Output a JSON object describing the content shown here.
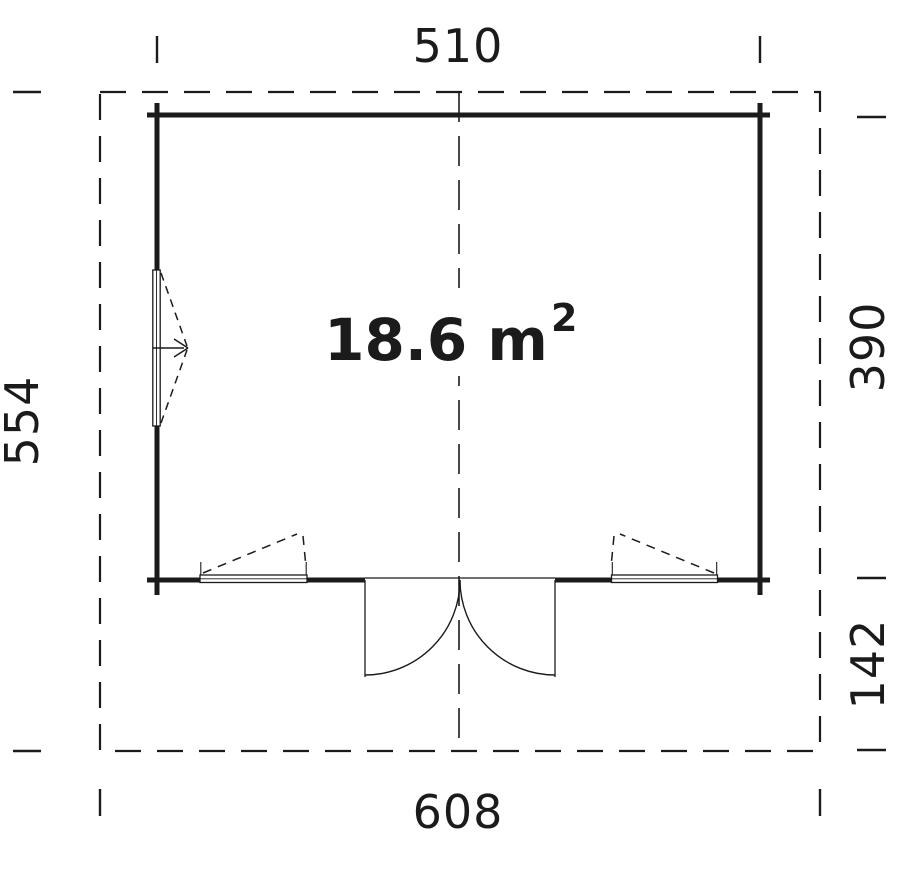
{
  "floor_plan": {
    "area_label": {
      "text": "18.6 m",
      "exponent": "2"
    },
    "dimensions": {
      "top_width": "510",
      "bottom_width": "608",
      "left_depth": "554",
      "right_inner_depth": "390",
      "right_overhang_depth": "142"
    },
    "colors": {
      "line": "#1b1b1b",
      "background": "#ffffff"
    }
  }
}
